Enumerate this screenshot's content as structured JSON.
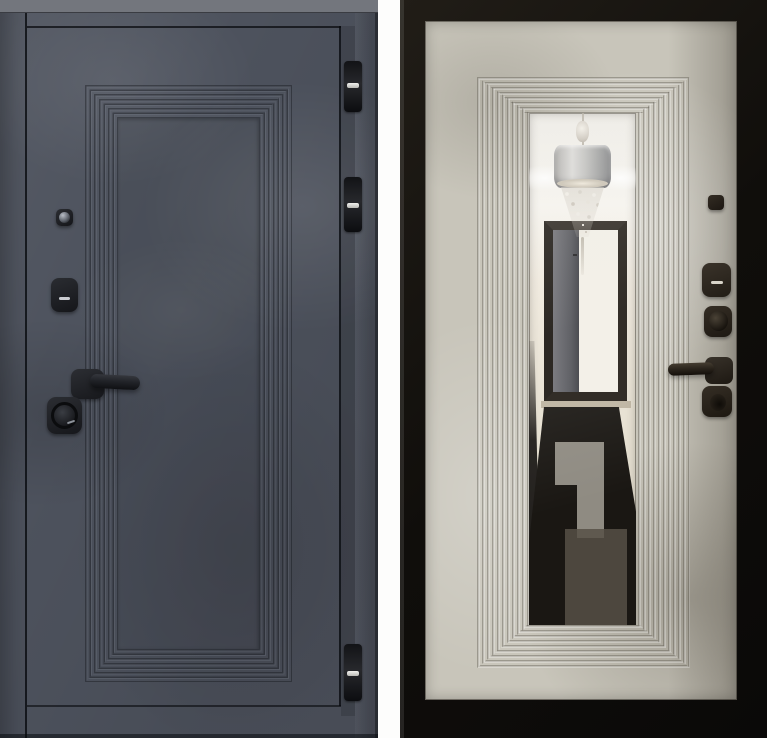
{
  "scene": {
    "kind": "product photograph",
    "alt": "Steel entry door shown from both sides, two photos side by side",
    "left_panel": {
      "alt": "Exterior side of the door: dark graphite concrete-textured leaf with a stepped rectangular panel molding, peephole, keyhole escutcheon, black lever handle, round thumbturn and three black hinges on the right edge",
      "finish": "dark graphite concrete",
      "hardware": [
        "peephole",
        "keyhole-escutcheon",
        "lever-handle",
        "cylinder-thumbturn"
      ],
      "hinge_count": 3
    },
    "right_panel": {
      "alt": "Interior side of the door: light beige concrete-textured leaf in a black frame with a full-height mirror framed by stepped molding; dark bronze hardware column on the right",
      "finish": "light beige concrete",
      "hardware": [
        "peephole",
        "keyhole-escutcheon",
        "thumbturn",
        "lever-handle",
        "night-latch-knob"
      ],
      "reflection": {
        "alt": "Mirror reflection of a hallway: white ceiling with cove lighting, silver drum chandelier with crystal drops, open doorway with a dark gray interior door, and a dark patterned floor runner on a light floor"
      }
    },
    "colors": {
      "page-bg": "#fdfdfc",
      "left-door-base": "#4d525d",
      "left-frame-strip": "#444954",
      "left-top-band": "#73767d",
      "seam-dark": "#14161b",
      "hardware-black": "#1b1d21",
      "hardware-highlight": "#caccd1",
      "hinge-dark": "#17181c",
      "right-frame-black": "#14110d",
      "right-panel-beige": "#c8c5ba",
      "mirror-ceiling": "#f3f1ec",
      "chandelier-shade": "#b9b8b6",
      "doorway-frame": "#322d27",
      "rug-dark": "#1a1713",
      "rug-pattern": "#8f8b82",
      "floor-light": "#ddd7c7",
      "dark-bronze": "#2e2820"
    }
  }
}
